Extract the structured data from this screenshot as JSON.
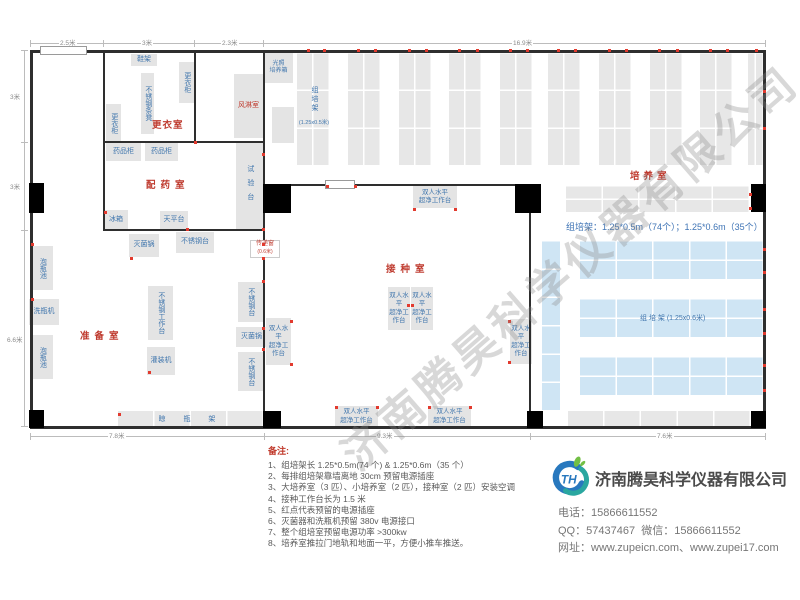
{
  "watermark": {
    "text": "济南腾昊科学仪器有限公司"
  },
  "plan": {
    "walls": [
      [
        30,
        50,
        736,
        3
      ],
      [
        30,
        426,
        736,
        3
      ],
      [
        30,
        50,
        3,
        379
      ],
      [
        763,
        50,
        3,
        379
      ],
      [
        103,
        50,
        2,
        181
      ],
      [
        194,
        50,
        2,
        93
      ],
      [
        263,
        50,
        2,
        379
      ],
      [
        104,
        141,
        160,
        2
      ],
      [
        104,
        229,
        160,
        2
      ],
      [
        264,
        184,
        266,
        2
      ],
      [
        529,
        185,
        2,
        243
      ]
    ],
    "pillars": [
      [
        29,
        183,
        15,
        30
      ],
      [
        263,
        184,
        28,
        29
      ],
      [
        515,
        184,
        26,
        29
      ],
      [
        751,
        184,
        15,
        28
      ],
      [
        29,
        410,
        15,
        18
      ],
      [
        263,
        411,
        18,
        17
      ],
      [
        527,
        411,
        16,
        17
      ],
      [
        751,
        411,
        15,
        17
      ]
    ],
    "doors": [
      [
        40,
        46,
        47,
        9
      ],
      [
        325,
        180,
        30,
        9
      ]
    ],
    "columns": {
      "xs": [
        297,
        348,
        399,
        449,
        500,
        548,
        599,
        650,
        700,
        748
      ],
      "y": 52,
      "w": 33,
      "lastW": 16,
      "h": 113,
      "c": 2,
      "r": 3
    },
    "shelves": [
      {
        "x": 566,
        "y": 185,
        "w": 184,
        "h": 27,
        "c": 5,
        "r": 2
      },
      {
        "x": 542,
        "y": 240,
        "w": 18,
        "h": 170,
        "c": 1,
        "r": 6,
        "blue": 1
      },
      {
        "x": 580,
        "y": 240,
        "w": 184,
        "h": 39,
        "c": 5,
        "r": 2,
        "blue": 1
      },
      {
        "x": 580,
        "y": 298,
        "w": 184,
        "h": 39,
        "c": 5,
        "r": 2,
        "blue": 1
      },
      {
        "x": 580,
        "y": 356,
        "w": 184,
        "h": 39,
        "c": 5,
        "r": 2,
        "blue": 1
      },
      {
        "x": 568,
        "y": 411,
        "w": 183,
        "h": 16,
        "c": 5,
        "r": 1
      },
      {
        "x": 118,
        "y": 411,
        "w": 146,
        "h": 16,
        "c": 4,
        "r": 1,
        "label": "晾 瓶 架"
      }
    ],
    "furniture": [
      {
        "t": "鞋架",
        "x": 131,
        "y": 54,
        "w": 26,
        "h": 12
      },
      {
        "t": "更衣柜",
        "x": 179,
        "y": 62,
        "w": 15,
        "h": 41,
        "v": 1
      },
      {
        "t": "不锈钢条凳",
        "x": 141,
        "y": 73,
        "w": 13,
        "h": 61,
        "v": 1
      },
      {
        "t": "更衣柜",
        "x": 106,
        "y": 104,
        "w": 15,
        "h": 38,
        "v": 1
      },
      {
        "t": "风淋室",
        "x": 234,
        "y": 74,
        "w": 29,
        "h": 64,
        "red": 1,
        "fs": 7
      },
      {
        "t": "药品柜",
        "x": 106,
        "y": 143,
        "w": 35,
        "h": 18
      },
      {
        "t": "药品柜",
        "x": 145,
        "y": 143,
        "w": 33,
        "h": 18
      },
      {
        "t": "试验台",
        "x": 236,
        "y": 142,
        "w": 27,
        "h": 88,
        "v": 1,
        "ls": 7
      },
      {
        "t": "冰箱",
        "x": 104,
        "y": 210,
        "w": 24,
        "h": 20
      },
      {
        "t": "天平台",
        "x": 160,
        "y": 211,
        "w": 28,
        "h": 18
      },
      {
        "t": "灭菌锅",
        "x": 129,
        "y": 234,
        "w": 30,
        "h": 23
      },
      {
        "t": "不锈钢台",
        "x": 176,
        "y": 232,
        "w": 38,
        "h": 21
      },
      {
        "t": "泡瓶池",
        "x": 31,
        "y": 246,
        "w": 22,
        "h": 44,
        "v": 1
      },
      {
        "t": "洗瓶机",
        "x": 29,
        "y": 299,
        "w": 30,
        "h": 26
      },
      {
        "t": "泡瓶池",
        "x": 31,
        "y": 335,
        "w": 22,
        "h": 44,
        "v": 1
      },
      {
        "t": "不锈钢工作台",
        "x": 148,
        "y": 286,
        "w": 25,
        "h": 54,
        "v": 1
      },
      {
        "t": "灌装机",
        "x": 147,
        "y": 347,
        "w": 28,
        "h": 28
      },
      {
        "t": "不锈钢台",
        "x": 238,
        "y": 282,
        "w": 25,
        "h": 40,
        "v": 1
      },
      {
        "t": "灭菌锅",
        "x": 236,
        "y": 327,
        "w": 31,
        "h": 20
      },
      {
        "t": "不锈钢台",
        "x": 238,
        "y": 352,
        "w": 25,
        "h": 39,
        "v": 1
      },
      {
        "t": "光照\n培养箱",
        "x": 264,
        "y": 53,
        "w": 29,
        "h": 30,
        "fs": 6
      },
      {
        "t": "",
        "x": 272,
        "y": 107,
        "w": 22,
        "h": 36
      },
      {
        "t": "双人水平\n超净工作台",
        "x": 413,
        "y": 186,
        "w": 44,
        "h": 22,
        "fs": 6.5
      },
      {
        "t": "双人水平\n超净工作台",
        "x": 388,
        "y": 287,
        "w": 22,
        "h": 43,
        "fs": 6.5
      },
      {
        "t": "双人水平\n超净工作台",
        "x": 411,
        "y": 287,
        "w": 22,
        "h": 43,
        "fs": 6.5
      },
      {
        "t": "双人水平\n超净工作台",
        "x": 266,
        "y": 318,
        "w": 25,
        "h": 47,
        "fs": 6.5
      },
      {
        "t": "双人水平\n超净工作台",
        "x": 510,
        "y": 319,
        "w": 22,
        "h": 45,
        "fs": 6.5
      },
      {
        "t": "双人水平\n超净工作台",
        "x": 335,
        "y": 406,
        "w": 43,
        "h": 21,
        "fs": 6.5
      },
      {
        "t": "双人水平\n超净工作台",
        "x": 428,
        "y": 406,
        "w": 43,
        "h": 21,
        "fs": 6.5
      }
    ],
    "rooms": [
      {
        "t": "更衣室",
        "x": 152,
        "y": 117,
        "ls": 1
      },
      {
        "t": "配药室",
        "x": 146,
        "y": 177,
        "ls": 5
      },
      {
        "t": "准备室",
        "x": 80,
        "y": 328,
        "ls": 5
      },
      {
        "t": "接种室",
        "x": 386,
        "y": 261,
        "ls": 5
      },
      {
        "t": "培养室",
        "x": 630,
        "y": 168,
        "ls": 4
      }
    ],
    "outlets": [
      [
        307,
        49
      ],
      [
        323,
        49
      ],
      [
        357,
        49
      ],
      [
        374,
        49
      ],
      [
        408,
        49
      ],
      [
        425,
        49
      ],
      [
        458,
        49
      ],
      [
        476,
        49
      ],
      [
        509,
        49
      ],
      [
        526,
        49
      ],
      [
        557,
        49
      ],
      [
        574,
        49
      ],
      [
        608,
        49
      ],
      [
        625,
        49
      ],
      [
        658,
        49
      ],
      [
        676,
        49
      ],
      [
        709,
        49
      ],
      [
        726,
        49
      ],
      [
        755,
        49
      ],
      [
        763,
        90
      ],
      [
        763,
        127
      ],
      [
        763,
        248
      ],
      [
        763,
        271
      ],
      [
        763,
        308
      ],
      [
        763,
        332
      ],
      [
        763,
        364
      ],
      [
        763,
        389
      ],
      [
        749,
        193
      ],
      [
        749,
        207
      ],
      [
        413,
        208
      ],
      [
        454,
        208
      ],
      [
        407,
        304
      ],
      [
        411,
        304
      ],
      [
        290,
        320
      ],
      [
        290,
        363
      ],
      [
        508,
        320
      ],
      [
        508,
        361
      ],
      [
        335,
        406
      ],
      [
        376,
        406
      ],
      [
        428,
        406
      ],
      [
        469,
        406
      ],
      [
        326,
        185
      ],
      [
        354,
        185
      ],
      [
        31,
        298
      ],
      [
        31,
        243
      ],
      [
        262,
        153
      ],
      [
        262,
        243
      ],
      [
        262,
        257
      ],
      [
        262,
        280
      ],
      [
        262,
        327
      ],
      [
        262,
        348
      ],
      [
        130,
        257
      ],
      [
        148,
        371
      ],
      [
        118,
        413
      ],
      [
        104,
        211
      ],
      [
        186,
        228
      ],
      [
        262,
        228
      ],
      [
        194,
        141
      ]
    ],
    "dims": {
      "lines": [
        [
          30,
          43,
          736,
          1
        ],
        [
          24,
          50,
          1,
          377
        ],
        [
          30,
          436,
          736,
          1
        ]
      ],
      "ticks": [
        [
          30,
          40,
          1,
          7
        ],
        [
          103,
          40,
          1,
          7
        ],
        [
          194,
          40,
          1,
          7
        ],
        [
          263,
          40,
          1,
          7
        ],
        [
          765,
          40,
          1,
          7
        ],
        [
          21,
          50,
          7,
          1
        ],
        [
          21,
          142,
          7,
          1
        ],
        [
          21,
          230,
          7,
          1
        ],
        [
          21,
          426,
          7,
          1
        ],
        [
          30,
          433,
          1,
          7
        ],
        [
          264,
          433,
          1,
          7
        ],
        [
          530,
          433,
          1,
          7
        ],
        [
          765,
          433,
          1,
          7
        ]
      ],
      "labels": [
        {
          "t": "2.5米",
          "x": 59,
          "y": 37
        },
        {
          "t": "3米",
          "x": 141,
          "y": 37
        },
        {
          "t": "2.3米",
          "x": 221,
          "y": 37
        },
        {
          "t": "16.9米",
          "x": 512,
          "y": 37
        },
        {
          "t": "3米",
          "x": 9,
          "y": 91
        },
        {
          "t": "3米",
          "x": 9,
          "y": 181
        },
        {
          "t": "6.6米",
          "x": 6,
          "y": 334
        },
        {
          "t": "7.8米",
          "x": 108,
          "y": 430
        },
        {
          "t": "9.3米",
          "x": 376,
          "y": 430
        },
        {
          "t": "7.6米",
          "x": 656,
          "y": 430
        }
      ]
    },
    "pass_window": {
      "x": 250,
      "y": 240,
      "w": 30,
      "h": 18,
      "l1": "传递窗",
      "l2": "(0.6米)"
    },
    "culture_annotation": {
      "x": 566,
      "y": 220,
      "t": "组培架：1.25*0.5m（74个）；1.25*0.6m（35个）"
    },
    "col1_label": {
      "x": 293,
      "y": 86,
      "main": "组培架",
      "sub": "(1.25x0.5米)"
    },
    "bar_label": {
      "x": 640,
      "y": 313,
      "t": "组 培 架 (1.25x0.6米)"
    }
  },
  "notes": {
    "title": "备注:",
    "items": [
      "1、组培架长 1.25*0.5m(74 个) & 1.25*0.6m（35 个）",
      "2、每排组培架靠墙离地 30cm 预留电源插座",
      "3、大培养室（3 匹）、小培养室（2 匹），接种室（2 匹）安装空调",
      "4、接种工作台长为 1.5 米",
      "5、红点代表预留的电源插座",
      "6、灭菌器和洗瓶机预留 380v 电源接口",
      "7、整个组培室预留电源功率 >300kw",
      "8、培养室推拉门地轨和地面一平，方便小推车推送。"
    ]
  },
  "company": {
    "logo_text": "TH",
    "name": "济南腾昊科学仪器有限公司",
    "phone_label": "电话：",
    "phone": "15866611552",
    "qq_label": "QQ：",
    "qq": "57437467",
    "wechat_label": "微信：",
    "wechat": "15866611552",
    "web_label": "网址：",
    "websites": "www.zupeicn.com、www.zupei17.com"
  },
  "colors": {
    "room_label": "#bf3b2f",
    "furniture_label": "#4076ad",
    "shelf_gray": "#e7e7e7",
    "shelf_blue": "#cfe5f4",
    "outlet_red": "#e23a2e",
    "logo_blue": "#2878be",
    "logo_teal": "#2aa7a0",
    "logo_green": "#72bf44"
  }
}
